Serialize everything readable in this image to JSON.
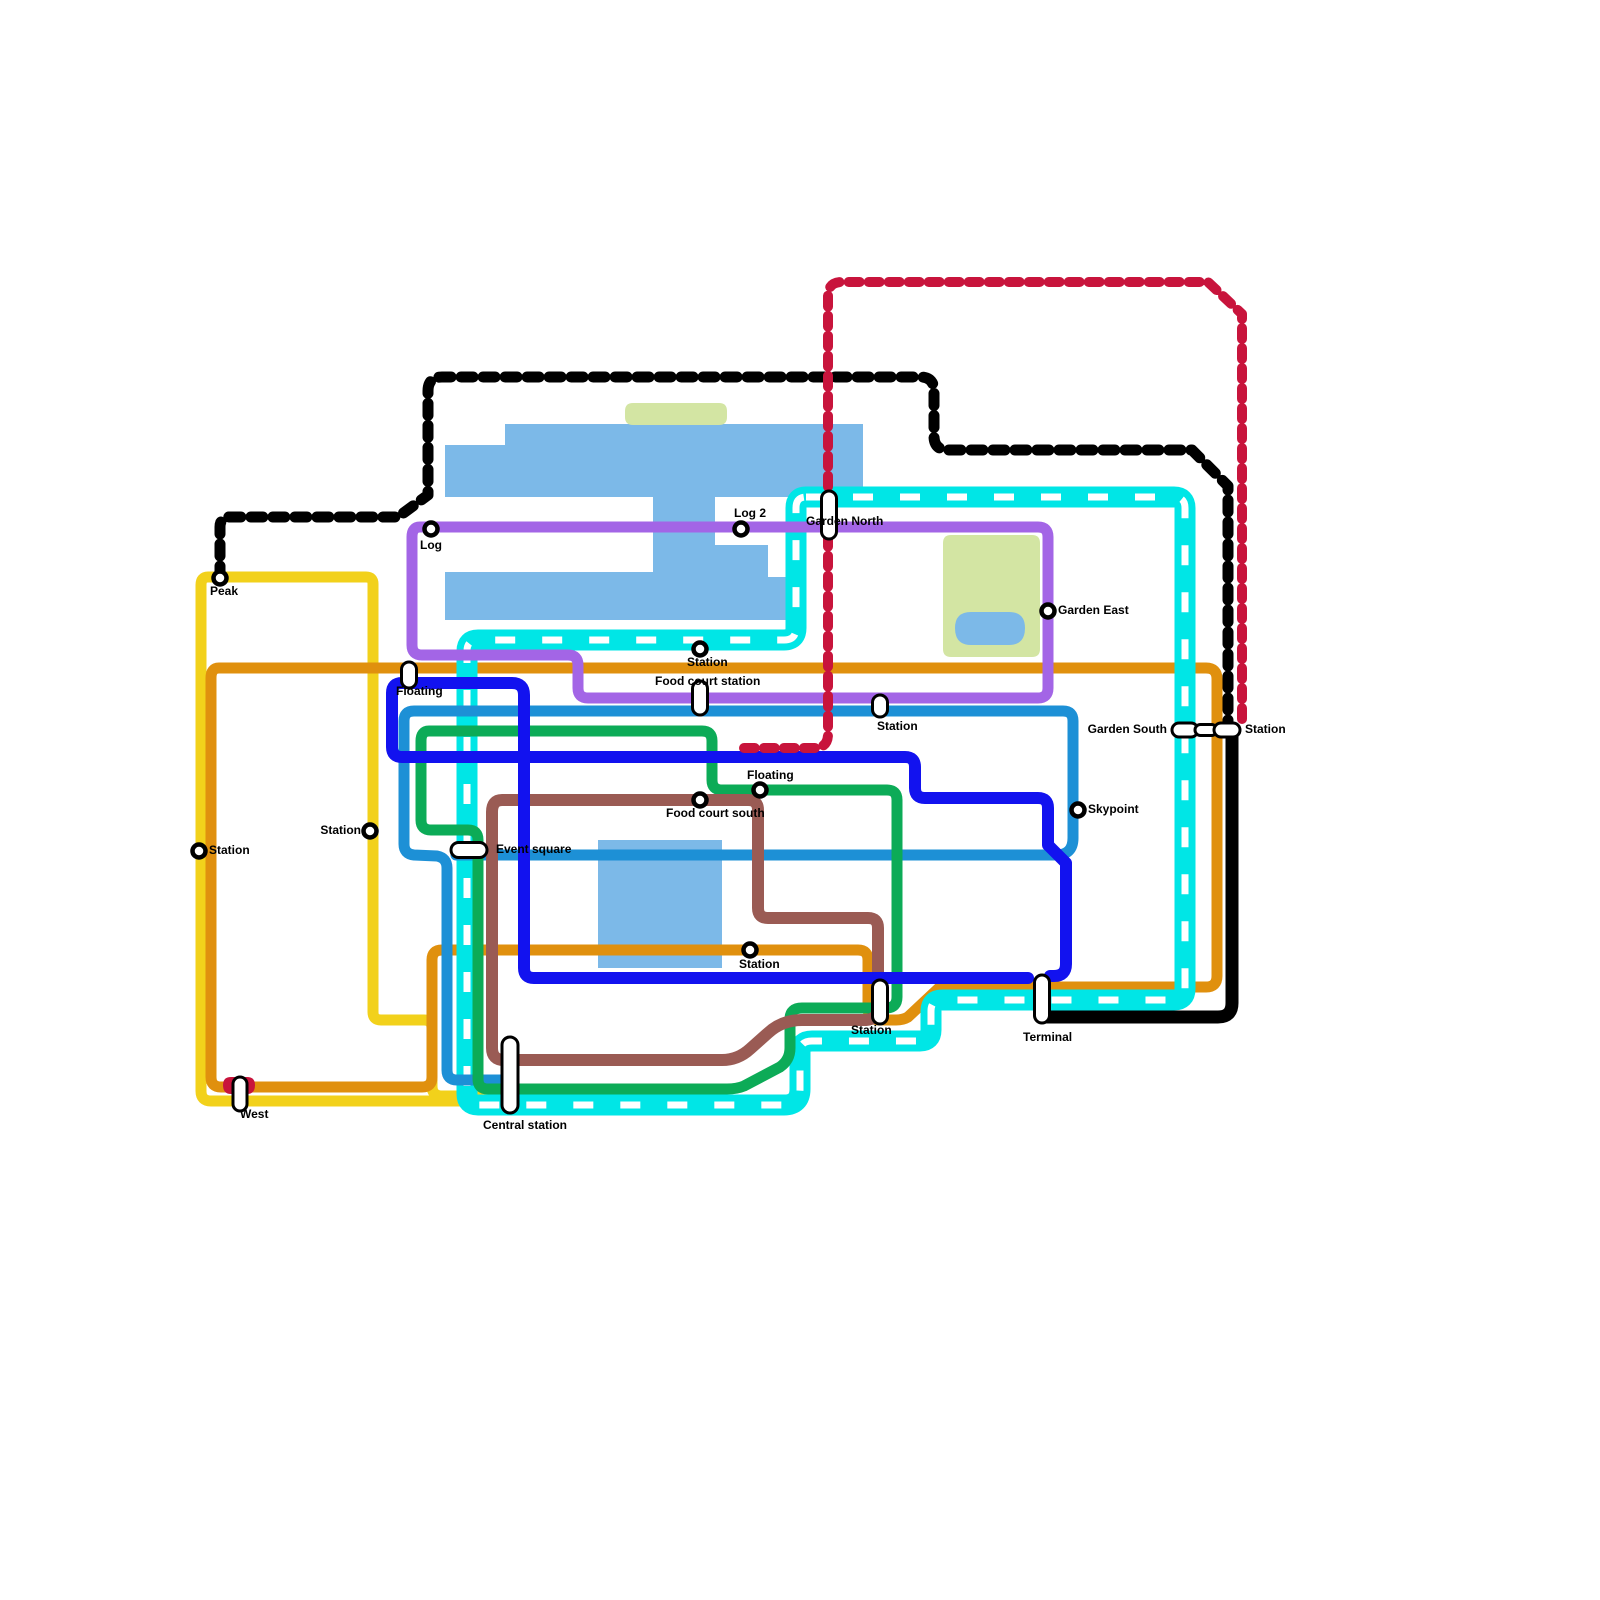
{
  "canvas": {
    "width": 1600,
    "height": 1600,
    "background": "#ffffff"
  },
  "palette": {
    "water": "#7cb9e8",
    "park": "#d3e5a3",
    "pond": "#7cb9e8",
    "yellow": "#f2d11b",
    "orange": "#e0900e",
    "cyan": "#00e6e6",
    "purple": "#a365e6",
    "azure": "#1d90d6",
    "green": "#0cab57",
    "blue": "#1212ef",
    "brown": "#9a5b54",
    "black": "#000000",
    "crimson": "#c8143c",
    "station_fill": "#ffffff",
    "station_stroke": "#000000"
  },
  "areas": [
    {
      "id": "water-main",
      "kind": "water",
      "path": "M505,424 H863 V497 H715 V545 H768 V577 H797 V620 H445 V572 H653 V497 H445 V445 H505 Z"
    },
    {
      "id": "water-square",
      "kind": "water",
      "path": "M598,840 H722 V968 H598 Z"
    },
    {
      "id": "park-north",
      "kind": "park",
      "path": "M633,403 H719 Q727,403 727,411 V417 Q727,425 719,425 H633 Q625,425 625,417 V411 Q625,403 633,403 Z"
    },
    {
      "id": "park-east",
      "kind": "park",
      "path": "M951,535 H1032 Q1040,535 1040,543 V649 Q1040,657 1032,657 H951 Q943,657 943,649 V543 Q943,535 951,535 Z"
    },
    {
      "id": "pond-east",
      "kind": "pond",
      "path": "M971,612 H1009 Q1025,612 1025,628 Q1025,645 1009,645 H971 Q955,645 955,628 Q955,612 971,612 Z"
    }
  ],
  "lines": [
    {
      "id": "yellow-line",
      "color_key": "yellow",
      "width": 11,
      "path": "M618,1096 H442 Q432,1096 432,1086 V1028 Q432,1020 424,1020 H381 Q373,1020 373,1012 V584 Q373,577 366,577 H208 Q201,577 201,585 V1091 Q201,1101 211,1101 H618"
    },
    {
      "id": "orange-line",
      "color_key": "orange",
      "width": 11,
      "path": "M219,668 H1206 Q1217,668 1217,679 V976 Q1217,987 1206,987 H940 L908,1017 Q903,1020 896,1020 H880 Q868,1020 868,1008 V960 Q868,950 858,950 H442 Q432,950 432,960 V1077 Q432,1087 422,1087 H221 Q211,1087 211,1077 V678 Q211,668 219,668 Z"
    },
    {
      "id": "cyan-line",
      "color_key": "cyan",
      "width": 21,
      "path": "M806,497 H1174 Q1185,497 1185,508 V989 Q1185,1000 1174,1000 H942 Q931,1000 931,1011 V1030 Q931,1041 920,1041 H812 Q800,1041 800,1052 V1089 Q800,1105 784,1105 H478 Q467,1105 467,1094 V651 Q467,640 478,640 H784 Q796,640 796,628 V508 Q796,497 806,497 Z",
      "overlay": {
        "color": "#ffffff",
        "width": 7,
        "dasharray": "20 27"
      }
    },
    {
      "id": "purple-line",
      "color_key": "purple",
      "width": 11,
      "path": "M420,527 H1038 Q1048,527 1048,537 V688 Q1048,698 1038,698 H588 Q578,698 578,688 V665 Q578,655 568,655 H422 Q412,655 412,645 V537 Q412,527 420,527 Z"
    },
    {
      "id": "azure-line",
      "color_key": "azure",
      "width": 11,
      "path": "M508,1080 H457 Q447,1080 447,1070 V868 Q447,858 437,856 L414,855 Q404,854 404,844 V721 Q404,711 414,711 H1063 Q1073,711 1073,721 V838 Q1073,855 1056,855 H456"
    },
    {
      "id": "green-line",
      "color_key": "green",
      "width": 11,
      "path": "M429,731 H702 Q712,731 712,741 V780 Q712,790 722,790 H887 Q897,790 897,800 V997 Q897,1008 886,1008 H802 Q790,1008 790,1019 V1048 Q790,1060 780,1067 L744,1086 Q737,1089 727,1089 H488 Q478,1089 478,1079 V840 Q478,830 468,830 H431 Q421,830 421,820 V741 Q421,731 429,731 Z"
    },
    {
      "id": "brown-line",
      "color_key": "brown",
      "width": 12,
      "path": "M502,800 H748 Q758,800 758,810 V908 Q758,918 768,918 H868 Q878,918 878,928 V1008 Q878,1019 866,1020 H802 Q782,1020 768,1033 L750,1049 Q738,1060 722,1060 H504 Q492,1060 492,1048 V812 Q492,800 502,800 Z"
    },
    {
      "id": "blue-line",
      "color_key": "blue",
      "width": 12,
      "path": "M1028,978 H534 Q524,978 524,968 V695 Q524,683 512,683 H402 Q392,683 392,693 V747 Q392,757 402,757 H905 Q915,757 915,767 V788 Q915,798 925,798 H1038 Q1048,798 1048,808 V845 L1066,863 V964 Q1066,976 1054,976 H1050"
    },
    {
      "id": "black-dashed-line",
      "color_key": "black",
      "width": 11,
      "dasharray": "12 10",
      "path": "M220,578 V527 Q220,517 230,517 H398 L428,495 V391 Q428,377 442,377 H920 Q934,377 934,391 V436 Q934,450 948,450 H1192 L1228,486 V722"
    },
    {
      "id": "crimson-dashed-line",
      "color_key": "crimson",
      "width": 10,
      "dasharray": "11 9",
      "path": "M1242,719 V314 L1208,282 H842 Q828,282 828,296 V734 Q828,748 814,748 H744"
    },
    {
      "id": "black-solid-line",
      "color_key": "black",
      "width": 13,
      "path": "M1232,736 V1003 Q1232,1017 1218,1017 H1042"
    }
  ],
  "decals": [
    {
      "id": "crimson-terminus-west",
      "color_key": "crimson",
      "path": "M231,1077 H247 Q255,1077 255,1085 Q255,1094 247,1094 H231 Q223,1094 223,1085 Q223,1077 231,1077 Z"
    }
  ],
  "stations": [
    {
      "id": "peak",
      "label": "Peak",
      "marker": "circle",
      "x": 220,
      "y": 578,
      "label_x": 210,
      "label_y": 595,
      "anchor": "start"
    },
    {
      "id": "log",
      "label": "Log",
      "marker": "circle",
      "x": 431,
      "y": 529,
      "label_x": 420,
      "label_y": 549,
      "anchor": "start"
    },
    {
      "id": "log-2",
      "label": "Log 2",
      "marker": "circle",
      "x": 741,
      "y": 529,
      "label_x": 734,
      "label_y": 517,
      "anchor": "start"
    },
    {
      "id": "garden-north",
      "label": "Garden North",
      "marker": "pill",
      "x": 829,
      "y": 515,
      "w": 15,
      "h": 48,
      "label_x": 806,
      "label_y": 525,
      "anchor": "start"
    },
    {
      "id": "garden-east",
      "label": "Garden East",
      "marker": "circle",
      "x": 1048,
      "y": 611,
      "label_x": 1058,
      "label_y": 614,
      "anchor": "start"
    },
    {
      "id": "station-cyan-north",
      "label": "Station",
      "marker": "circle",
      "x": 700,
      "y": 649,
      "label_x": 687,
      "label_y": 666,
      "anchor": "start"
    },
    {
      "id": "food-court-station",
      "label": "Food court station",
      "marker": "pill",
      "x": 700,
      "y": 698,
      "w": 15,
      "h": 34,
      "label_x": 655,
      "label_y": 685,
      "anchor": "start"
    },
    {
      "id": "floating-west",
      "label": "Floating",
      "marker": "pill",
      "x": 409,
      "y": 675,
      "w": 15,
      "h": 26,
      "label_x": 396,
      "label_y": 695,
      "anchor": "start"
    },
    {
      "id": "station-purple-azure",
      "label": "Station",
      "marker": "pill",
      "x": 880,
      "y": 706,
      "w": 15,
      "h": 22,
      "label_x": 877,
      "label_y": 730,
      "anchor": "start"
    },
    {
      "id": "garden-south",
      "label": "Garden South",
      "marker": "pill-h",
      "x": 1185,
      "y": 730,
      "w": 26,
      "h": 14,
      "label_x": 1167,
      "label_y": 733,
      "anchor": "end"
    },
    {
      "id": "garden-south-link",
      "label": "",
      "marker": "pill-h",
      "x": 1206,
      "y": 730,
      "w": 22,
      "h": 11,
      "label_x": 0,
      "label_y": 0,
      "anchor": "start"
    },
    {
      "id": "station-red-terminus",
      "label": "Station",
      "marker": "pill-h",
      "x": 1227,
      "y": 730,
      "w": 26,
      "h": 14,
      "label_x": 1245,
      "label_y": 733,
      "anchor": "start"
    },
    {
      "id": "skypoint",
      "label": "Skypoint",
      "marker": "circle",
      "x": 1078,
      "y": 810,
      "label_x": 1088,
      "label_y": 813,
      "anchor": "start"
    },
    {
      "id": "floating-green",
      "label": "Floating",
      "marker": "circle",
      "x": 760,
      "y": 790,
      "label_x": 747,
      "label_y": 779,
      "anchor": "start"
    },
    {
      "id": "food-court-south",
      "label": "Food court south",
      "marker": "circle",
      "x": 700,
      "y": 800,
      "label_x": 666,
      "label_y": 817,
      "anchor": "start"
    },
    {
      "id": "station-yellow-west",
      "label": "Station",
      "marker": "circle",
      "x": 199,
      "y": 851,
      "label_x": 209,
      "label_y": 854,
      "anchor": "start"
    },
    {
      "id": "station-yellow-mid",
      "label": "Station",
      "marker": "circle",
      "x": 370,
      "y": 831,
      "label_x": 361,
      "label_y": 834,
      "anchor": "end"
    },
    {
      "id": "event-square",
      "label": "Event square",
      "marker": "pill-h",
      "x": 469,
      "y": 850,
      "w": 36,
      "h": 15,
      "label_x": 496,
      "label_y": 853,
      "anchor": "start"
    },
    {
      "id": "station-orange-mid",
      "label": "Station",
      "marker": "circle",
      "x": 750,
      "y": 950,
      "label_x": 739,
      "label_y": 968,
      "anchor": "start"
    },
    {
      "id": "station-bottom",
      "label": "Station",
      "marker": "pill",
      "x": 880,
      "y": 1002,
      "w": 15,
      "h": 44,
      "label_x": 851,
      "label_y": 1034,
      "anchor": "start"
    },
    {
      "id": "terminal",
      "label": "Terminal",
      "marker": "pill",
      "x": 1042,
      "y": 999,
      "w": 15,
      "h": 48,
      "label_x": 1023,
      "label_y": 1041,
      "anchor": "start"
    },
    {
      "id": "west",
      "label": "West",
      "marker": "pill",
      "x": 240,
      "y": 1094,
      "w": 14,
      "h": 34,
      "label_x": 240,
      "label_y": 1118,
      "anchor": "start"
    },
    {
      "id": "central-station",
      "label": "Central station",
      "marker": "pill",
      "x": 510,
      "y": 1075,
      "w": 16,
      "h": 76,
      "label_x": 483,
      "label_y": 1129,
      "anchor": "start"
    }
  ]
}
